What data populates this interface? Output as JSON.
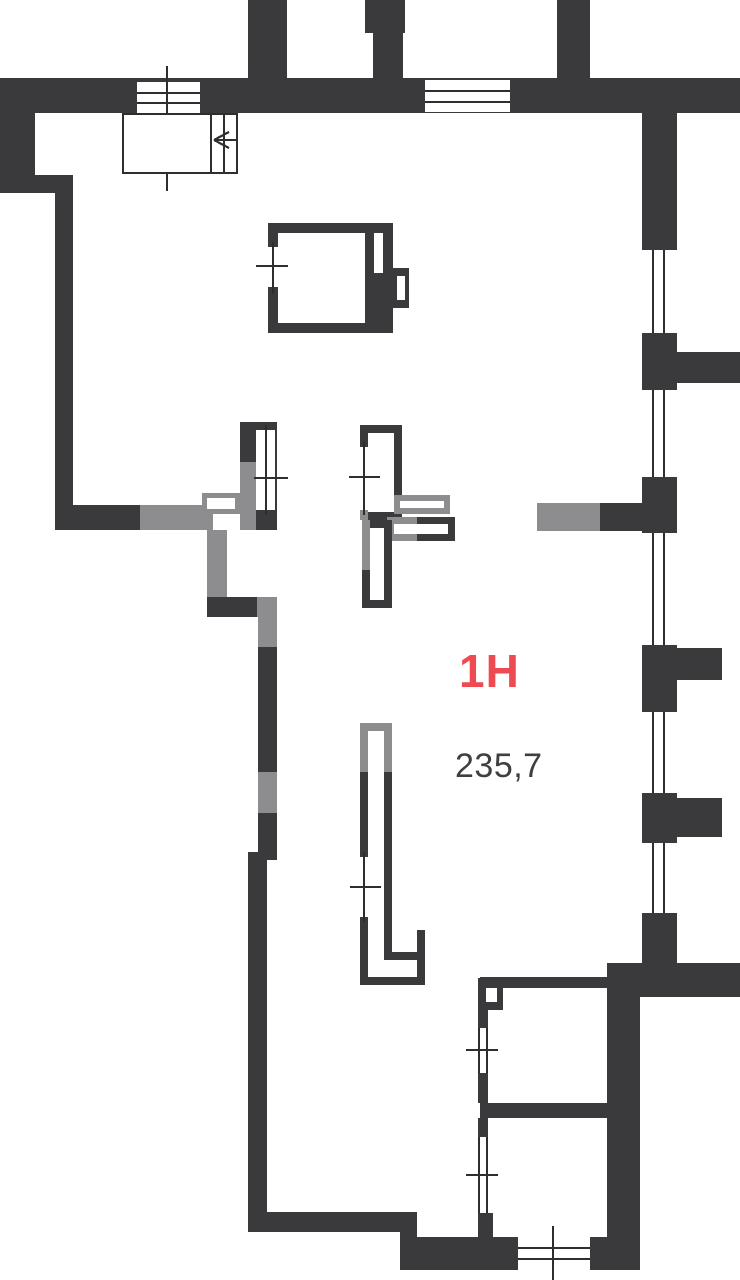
{
  "plan": {
    "unit_label": "1H",
    "area_value": "235,7"
  },
  "colors": {
    "wall": "#3a3a3c",
    "wall-light": "#8d8d8f",
    "line": "#2e2e30",
    "accent": "#ee4a52",
    "area-text": "#3f3f41",
    "background": "#ffffff"
  }
}
